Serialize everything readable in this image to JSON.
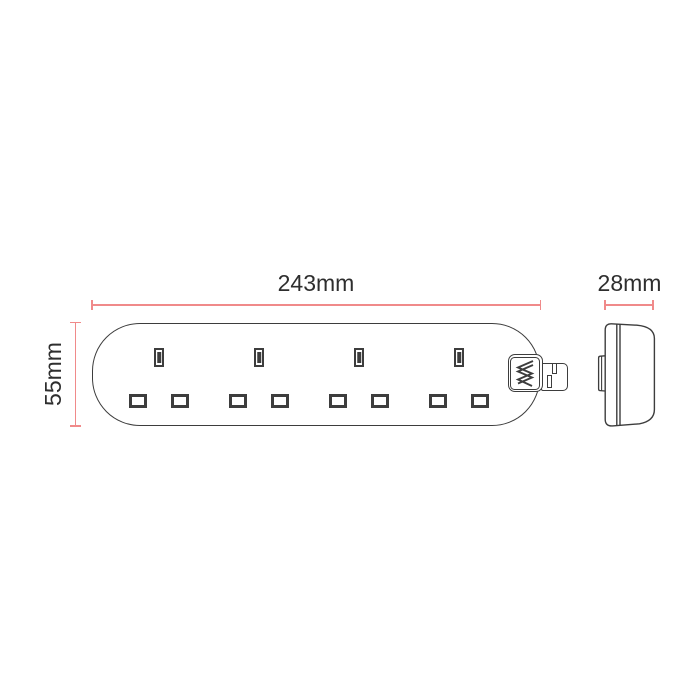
{
  "diagram": {
    "dimensions": {
      "width_label": "243mm",
      "height_label": "55mm",
      "depth_label": "28mm"
    },
    "front_view": {
      "socket_count": 4,
      "slots_per_socket": 3
    },
    "colors": {
      "dimension_line": "#f08a8a",
      "outline": "#3d3d3d",
      "label_text": "#2e2e2e",
      "background": "#ffffff"
    },
    "icons": {
      "endcap": "strain-relief-zigzag-icon"
    }
  }
}
